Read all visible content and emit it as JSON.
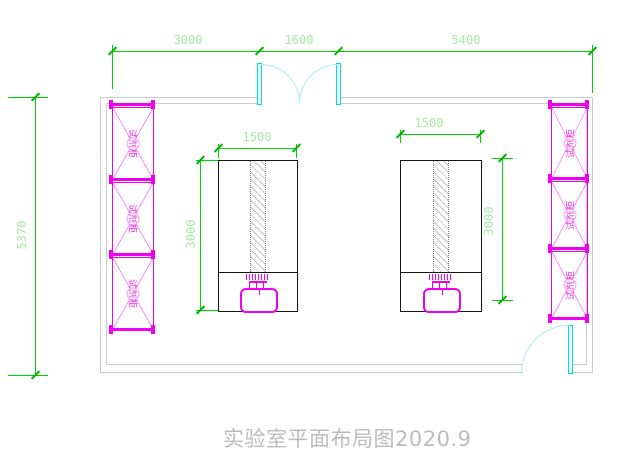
{
  "title": "实验室平面布局图2020.9",
  "dimensions": {
    "top_segments": [
      "3000",
      "1600",
      "5400"
    ],
    "room_height": "5370",
    "bench_width": "1500",
    "bench_depth": "3000"
  },
  "cabinets": {
    "left": {
      "label": "试剂柜",
      "count": 3
    },
    "right": {
      "label": "试剂柜",
      "count": 3
    }
  },
  "colors": {
    "dimension_green": "#00d400",
    "cabinet_magenta": "#ff00ff",
    "door_cyan": "#00ffff",
    "wall_gray": "#cccccc",
    "bench_black": "#141414",
    "title_gray": "#bcbcbc"
  }
}
